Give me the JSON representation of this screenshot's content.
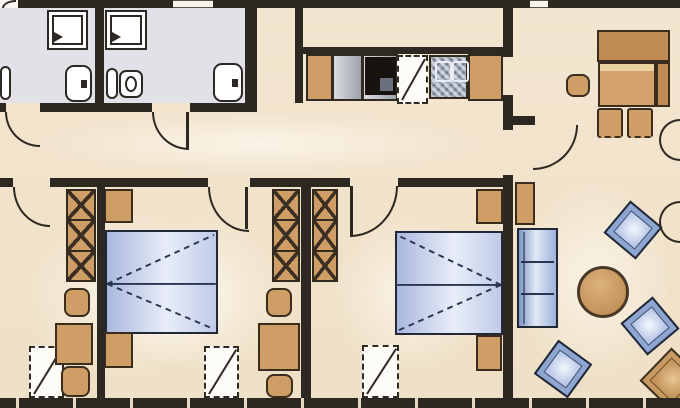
{
  "meta": {
    "description": "apartment floor plan, cropped on all sides; corridor with two bathrooms and open kitchenette on top, two bedrooms with dressing alcoves below, living-dining room at right",
    "width": 680,
    "height": 408
  },
  "palette": {
    "floor_cream": "#f1e3cb",
    "floor_gray": "#e2e1e8",
    "wall_dark": "#2e2822",
    "furniture_tan": "#cf9e66",
    "bench_tan_dark": "#c08c54",
    "bed_blue": "#a9b8dd",
    "bed_blue_light": "#e8edf8",
    "sofa_blue": "#9eb2da",
    "white": "#ffffff",
    "outline": "#3a2d1e"
  },
  "rooms": [
    {
      "name": "bathroom-1"
    },
    {
      "name": "bathroom-2"
    },
    {
      "name": "corridor"
    },
    {
      "name": "kitchenette"
    },
    {
      "name": "dressing-room"
    },
    {
      "name": "bedroom-1"
    },
    {
      "name": "bedroom-2"
    },
    {
      "name": "living-dining-room"
    }
  ],
  "elements": [
    {
      "name": "page-margin-top-left",
      "type": "floor",
      "x": 0,
      "y": 0,
      "w": 18,
      "h": 8,
      "color": "#f8f6f1"
    },
    {
      "name": "bathroom-1-floor",
      "type": "floor",
      "x": 0,
      "y": 8,
      "w": 95,
      "h": 95,
      "color": "#e2e1e8"
    },
    {
      "name": "bathroom-2-floor",
      "type": "floor",
      "x": 103,
      "y": 8,
      "w": 142,
      "h": 95,
      "color": "#e2e1e8"
    },
    {
      "name": "dressing-room-glow",
      "type": "glow",
      "x": 20,
      "y": 210,
      "w": 220,
      "h": 170
    },
    {
      "name": "bedroom-1-glow",
      "type": "glow",
      "x": 110,
      "y": 215,
      "w": 180,
      "h": 160
    },
    {
      "name": "bedroom-2-glow",
      "type": "glow",
      "x": 330,
      "y": 215,
      "w": 160,
      "h": 160
    },
    {
      "name": "living-room-glow",
      "type": "glow",
      "x": 515,
      "y": 180,
      "w": 160,
      "h": 200
    },
    {
      "name": "corridor-glow",
      "type": "glow",
      "x": 30,
      "y": 112,
      "w": 460,
      "h": 64
    },
    {
      "name": "exterior-wall-top-a",
      "type": "wall",
      "x": 18,
      "y": 0,
      "w": 155,
      "h": 8
    },
    {
      "name": "exterior-wall-top-b",
      "type": "wall",
      "x": 213,
      "y": 0,
      "w": 317,
      "h": 8
    },
    {
      "name": "exterior-wall-top-c",
      "type": "wall",
      "x": 548,
      "y": 0,
      "w": 132,
      "h": 8
    },
    {
      "name": "top-window-1",
      "type": "window",
      "x": 173,
      "y": 0,
      "w": 40,
      "h": 8
    },
    {
      "name": "top-window-2",
      "type": "window",
      "x": 530,
      "y": 0,
      "w": 18,
      "h": 8
    },
    {
      "name": "bathroom-divider-wall",
      "type": "wall",
      "x": 95,
      "y": 8,
      "w": 9,
      "h": 95
    },
    {
      "name": "bathroom-right-wall",
      "type": "wall",
      "x": 245,
      "y": 8,
      "w": 12,
      "h": 95
    },
    {
      "name": "bathroom-bottom-wall-a",
      "type": "wall",
      "x": 0,
      "y": 103,
      "w": 6,
      "h": 9
    },
    {
      "name": "bathroom-bottom-wall-b",
      "type": "wall",
      "x": 40,
      "y": 103,
      "w": 112,
      "h": 9
    },
    {
      "name": "bathroom-bottom-wall-c",
      "type": "wall",
      "x": 190,
      "y": 103,
      "w": 67,
      "h": 9
    },
    {
      "name": "kitchen-left-wall",
      "type": "wall",
      "x": 295,
      "y": 8,
      "w": 8,
      "h": 95
    },
    {
      "name": "kitchen-back-wall",
      "type": "wall",
      "x": 303,
      "y": 47,
      "w": 210,
      "h": 7
    },
    {
      "name": "kitchen-living-wall-a",
      "type": "wall",
      "x": 503,
      "y": 0,
      "w": 10,
      "h": 57
    },
    {
      "name": "kitchen-living-wall-b",
      "type": "wall",
      "x": 503,
      "y": 95,
      "w": 10,
      "h": 35
    },
    {
      "name": "living-door-jamb-stub",
      "type": "wall",
      "x": 513,
      "y": 116,
      "w": 22,
      "h": 9
    },
    {
      "name": "kitchen-living-wall-c",
      "type": "wall",
      "x": 503,
      "y": 175,
      "w": 10,
      "h": 233
    },
    {
      "name": "corridor-south-wall-a",
      "type": "wall",
      "x": 0,
      "y": 178,
      "w": 13,
      "h": 9
    },
    {
      "name": "corridor-south-wall-b",
      "type": "wall",
      "x": 50,
      "y": 178,
      "w": 158,
      "h": 9
    },
    {
      "name": "corridor-south-wall-c",
      "type": "wall",
      "x": 250,
      "y": 178,
      "w": 100,
      "h": 9
    },
    {
      "name": "corridor-south-wall-d",
      "type": "wall",
      "x": 398,
      "y": 178,
      "w": 105,
      "h": 9
    },
    {
      "name": "bed-head-partition-wall",
      "type": "wall",
      "x": 97,
      "y": 178,
      "w": 8,
      "h": 230
    },
    {
      "name": "bedroom-divider-wall",
      "type": "wall",
      "x": 301,
      "y": 178,
      "w": 10,
      "h": 230
    },
    {
      "name": "exterior-wall-bottom",
      "type": "wall-win",
      "x": 0,
      "y": 398,
      "w": 680,
      "h": 10
    },
    {
      "name": "cropped-arc-top-left",
      "type": "arc",
      "x": 2,
      "y": 0,
      "w": 14,
      "h": 8,
      "corner": "tl"
    },
    {
      "name": "bathroom-1-door-arc",
      "type": "arc",
      "x": 5,
      "y": 112,
      "w": 35,
      "h": 35,
      "corner": "bl"
    },
    {
      "name": "bathroom-2-door-arc",
      "type": "arc",
      "x": 152,
      "y": 112,
      "w": 37,
      "h": 38,
      "corner": "bl"
    },
    {
      "name": "bathroom-2-door-leaf",
      "type": "leaf",
      "x": 186,
      "y": 112,
      "w": 3,
      "h": 38
    },
    {
      "name": "dressing-room-door-arc",
      "type": "arc",
      "x": 13,
      "y": 187,
      "w": 37,
      "h": 40,
      "corner": "bl"
    },
    {
      "name": "bedroom-1-door-arc",
      "type": "arc",
      "x": 208,
      "y": 187,
      "w": 41,
      "h": 45,
      "corner": "bl"
    },
    {
      "name": "bedroom-1-door-leaf",
      "type": "leaf",
      "x": 245,
      "y": 187,
      "w": 3,
      "h": 42
    },
    {
      "name": "bedroom-2-door-arc",
      "type": "arc",
      "x": 350,
      "y": 186,
      "w": 48,
      "h": 51,
      "corner": "br"
    },
    {
      "name": "bedroom-2-door-leaf",
      "type": "leaf",
      "x": 350,
      "y": 186,
      "w": 3,
      "h": 51
    },
    {
      "name": "living-room-door-arc",
      "type": "arc",
      "x": 533,
      "y": 125,
      "w": 45,
      "h": 45,
      "corner": "br"
    },
    {
      "name": "right-edge-door-arc-1",
      "type": "arc",
      "x": 659,
      "y": 119,
      "w": 21,
      "h": 42,
      "corner": "half-left"
    },
    {
      "name": "right-edge-door-arc-2",
      "type": "arc",
      "x": 659,
      "y": 201,
      "w": 21,
      "h": 42,
      "corner": "half-left"
    },
    {
      "name": "shower-1",
      "type": "shower",
      "x": 47,
      "y": 10,
      "w": 41,
      "h": 40
    },
    {
      "name": "shower-2",
      "type": "shower",
      "x": 105,
      "y": 10,
      "w": 42,
      "h": 40
    },
    {
      "name": "toilet-1",
      "type": "toilet",
      "x": 65,
      "y": 65,
      "w": 27,
      "h": 37,
      "dot": "right"
    },
    {
      "name": "cropped-fixture-left-edge",
      "type": "basin",
      "x": 0,
      "y": 66,
      "w": 11,
      "h": 34,
      "noring": true
    },
    {
      "name": "bidet",
      "type": "basin",
      "x": 106,
      "y": 68,
      "w": 12,
      "h": 31,
      "noring": true
    },
    {
      "name": "washbasin",
      "type": "basin",
      "x": 119,
      "y": 70,
      "w": 24,
      "h": 28
    },
    {
      "name": "toilet-2",
      "type": "toilet",
      "x": 213,
      "y": 63,
      "w": 30,
      "h": 39,
      "dot": "right"
    },
    {
      "name": "kitchen-cabinet-1",
      "type": "counter-cab",
      "x": 306,
      "y": 54,
      "w": 27,
      "h": 47
    },
    {
      "name": "kitchen-appliance",
      "type": "counter-gray",
      "x": 332,
      "y": 54,
      "w": 31,
      "h": 47
    },
    {
      "name": "stove-counter",
      "type": "counter-gray",
      "x": 362,
      "y": 54,
      "w": 36,
      "h": 47
    },
    {
      "name": "stove",
      "type": "stove",
      "x": 365,
      "y": 57,
      "w": 31,
      "h": 38
    },
    {
      "name": "dishwasher-dashed",
      "type": "dash-appl",
      "x": 397,
      "y": 55,
      "w": 31,
      "h": 49
    },
    {
      "name": "kitchen-sink",
      "type": "sink",
      "x": 429,
      "y": 55,
      "w": 39,
      "h": 44
    },
    {
      "name": "kitchen-cabinet-2",
      "type": "counter-cab",
      "x": 468,
      "y": 54,
      "w": 35,
      "h": 47
    },
    {
      "name": "wardrobe-1",
      "type": "wardrobe",
      "x": 66,
      "y": 189,
      "w": 30,
      "h": 93,
      "cells": 3
    },
    {
      "name": "stool-1",
      "type": "stool",
      "x": 64,
      "y": 288,
      "w": 26,
      "h": 29
    },
    {
      "name": "vanity-table-1",
      "type": "furn",
      "x": 55,
      "y": 323,
      "w": 38,
      "h": 42
    },
    {
      "name": "stool-2",
      "type": "stool",
      "x": 61,
      "y": 366,
      "w": 29,
      "h": 31
    },
    {
      "name": "roof-window-1",
      "type": "dashed-window",
      "x": 29,
      "y": 346,
      "w": 35,
      "h": 52
    },
    {
      "name": "nightstand-1",
      "type": "furn",
      "x": 104,
      "y": 189,
      "w": 29,
      "h": 34
    },
    {
      "name": "double-bed-1",
      "type": "bed",
      "x": 105,
      "y": 230,
      "w": 113,
      "h": 104,
      "head": "left"
    },
    {
      "name": "nightstand-2",
      "type": "furn",
      "x": 104,
      "y": 332,
      "w": 29,
      "h": 36
    },
    {
      "name": "roof-window-2",
      "type": "dashed-window",
      "x": 204,
      "y": 346,
      "w": 35,
      "h": 52
    },
    {
      "name": "wardrobe-2",
      "type": "wardrobe",
      "x": 272,
      "y": 189,
      "w": 28,
      "h": 93,
      "cells": 3
    },
    {
      "name": "stool-3",
      "type": "stool",
      "x": 266,
      "y": 288,
      "w": 26,
      "h": 29
    },
    {
      "name": "vanity-table-2",
      "type": "furn",
      "x": 258,
      "y": 323,
      "w": 42,
      "h": 48
    },
    {
      "name": "stool-4",
      "type": "stool",
      "x": 266,
      "y": 374,
      "w": 27,
      "h": 24
    },
    {
      "name": "wardrobe-3",
      "type": "wardrobe",
      "x": 312,
      "y": 189,
      "w": 26,
      "h": 93,
      "cells": 3
    },
    {
      "name": "nightstand-3",
      "type": "furn",
      "x": 476,
      "y": 189,
      "w": 27,
      "h": 35
    },
    {
      "name": "double-bed-2",
      "type": "bed",
      "x": 395,
      "y": 231,
      "w": 108,
      "h": 104,
      "head": "right"
    },
    {
      "name": "nightstand-4",
      "type": "furn",
      "x": 476,
      "y": 335,
      "w": 26,
      "h": 36
    },
    {
      "name": "roof-window-3",
      "type": "dashed-window",
      "x": 362,
      "y": 345,
      "w": 37,
      "h": 53
    },
    {
      "name": "dining-bench-top",
      "type": "bench",
      "x": 597,
      "y": 30,
      "w": 73,
      "h": 32
    },
    {
      "name": "dining-bench-right",
      "type": "bench",
      "x": 656,
      "y": 62,
      "w": 14,
      "h": 45
    },
    {
      "name": "dining-table",
      "type": "table",
      "x": 598,
      "y": 62,
      "w": 58,
      "h": 45
    },
    {
      "name": "dining-stool",
      "type": "stool",
      "x": 566,
      "y": 74,
      "w": 24,
      "h": 23
    },
    {
      "name": "dining-chair-1",
      "type": "chair",
      "x": 597,
      "y": 108,
      "w": 26,
      "h": 30
    },
    {
      "name": "dining-chair-2",
      "type": "chair",
      "x": 627,
      "y": 108,
      "w": 26,
      "h": 30
    },
    {
      "name": "sideboard",
      "type": "furn",
      "x": 515,
      "y": 182,
      "w": 20,
      "h": 43
    },
    {
      "name": "sofa",
      "type": "sofa",
      "x": 517,
      "y": 228,
      "w": 41,
      "h": 100
    },
    {
      "name": "round-coffee-table",
      "type": "round-table",
      "x": 577,
      "y": 266,
      "w": 52,
      "h": 52
    },
    {
      "name": "armchair-1",
      "type": "armchair",
      "x": 612,
      "y": 209,
      "w": 42,
      "h": 42,
      "rotate": 40
    },
    {
      "name": "armchair-2",
      "type": "armchair",
      "x": 629,
      "y": 305,
      "w": 42,
      "h": 42,
      "rotate": -40
    },
    {
      "name": "armchair-3",
      "type": "armchair",
      "x": 542,
      "y": 348,
      "w": 42,
      "h": 42,
      "rotate": 36
    },
    {
      "name": "armchair-4-tan",
      "type": "armchair",
      "x": 649,
      "y": 357,
      "w": 46,
      "h": 46,
      "rotate": 44,
      "variant": "tan"
    }
  ]
}
